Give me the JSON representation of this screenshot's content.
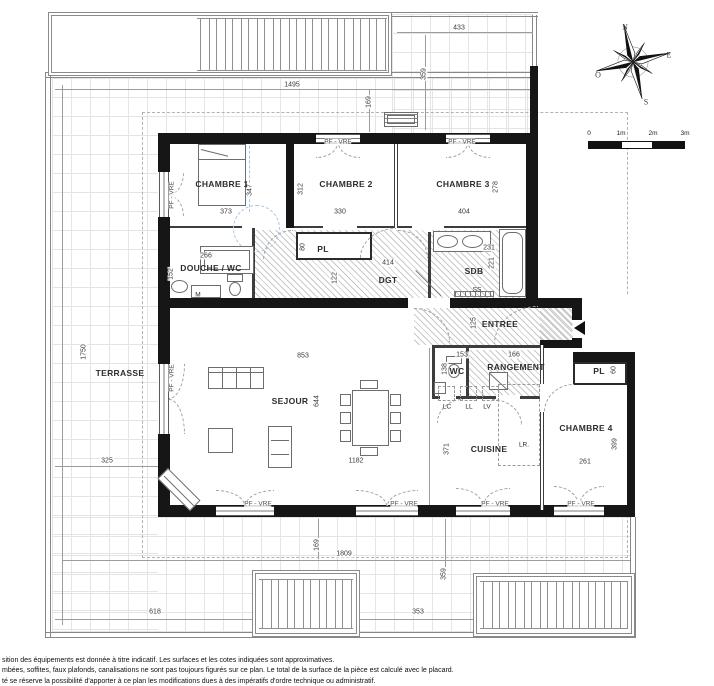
{
  "plan": {
    "window_label": "PF - VRE",
    "room_labels": [
      {
        "id": "chambre-1",
        "t": "CHAMBRE 1",
        "x": 222,
        "y": 184
      },
      {
        "id": "chambre-2",
        "t": "CHAMBRE 2",
        "x": 346,
        "y": 184
      },
      {
        "id": "chambre-3",
        "t": "CHAMBRE 3",
        "x": 463,
        "y": 184
      },
      {
        "id": "chambre-4",
        "t": "CHAMBRE 4",
        "x": 586,
        "y": 428
      },
      {
        "id": "douche-wc",
        "t": "DOUCHE / WC",
        "x": 211,
        "y": 268
      },
      {
        "id": "degagement",
        "t": "DGT",
        "x": 388,
        "y": 280
      },
      {
        "id": "salle-de-bains",
        "t": "SDB",
        "x": 474,
        "y": 271
      },
      {
        "id": "entree",
        "t": "ENTREE",
        "x": 500,
        "y": 324
      },
      {
        "id": "wc",
        "t": "WC",
        "x": 457,
        "y": 371
      },
      {
        "id": "rangement",
        "t": "RANGEMENT",
        "x": 516,
        "y": 367
      },
      {
        "id": "placard-couloir",
        "t": "PL",
        "x": 323,
        "y": 249
      },
      {
        "id": "placard-chambre-4",
        "t": "PL",
        "x": 599,
        "y": 371
      },
      {
        "id": "sejour",
        "t": "SEJOUR",
        "x": 290,
        "y": 401
      },
      {
        "id": "cuisine",
        "t": "CUISINE",
        "x": 489,
        "y": 449
      },
      {
        "id": "terrasse",
        "t": "TERRASSE",
        "x": 120,
        "y": 373
      }
    ],
    "dim_labels": [
      {
        "v": "1495",
        "x": 292,
        "y": 85
      },
      {
        "v": "433",
        "x": 459,
        "y": 28
      },
      {
        "v": "373",
        "x": 226,
        "y": 212
      },
      {
        "v": "330",
        "x": 340,
        "y": 212
      },
      {
        "v": "404",
        "x": 464,
        "y": 212
      },
      {
        "v": "266",
        "x": 206,
        "y": 256
      },
      {
        "v": "414",
        "x": 388,
        "y": 263
      },
      {
        "v": "231",
        "x": 489,
        "y": 248
      },
      {
        "v": "153",
        "x": 462,
        "y": 355
      },
      {
        "v": "166",
        "x": 514,
        "y": 355
      },
      {
        "v": "853",
        "x": 303,
        "y": 356
      },
      {
        "v": "1182",
        "x": 356,
        "y": 461
      },
      {
        "v": "261",
        "x": 585,
        "y": 462
      },
      {
        "v": "325",
        "x": 107,
        "y": 461
      },
      {
        "v": "618",
        "x": 155,
        "y": 612
      },
      {
        "v": "1809",
        "x": 344,
        "y": 554
      },
      {
        "v": "353",
        "x": 418,
        "y": 612
      },
      {
        "v": "359",
        "x": 424,
        "y": 74,
        "r": 1
      },
      {
        "v": "169",
        "x": 369,
        "y": 102,
        "r": 1
      },
      {
        "v": "347",
        "x": 250,
        "y": 190,
        "r": 1
      },
      {
        "v": "312",
        "x": 301,
        "y": 189,
        "r": 1
      },
      {
        "v": "278",
        "x": 496,
        "y": 187,
        "r": 1
      },
      {
        "v": "152",
        "x": 171,
        "y": 274,
        "r": 1
      },
      {
        "v": "80",
        "x": 303,
        "y": 247,
        "r": 1
      },
      {
        "v": "122",
        "x": 335,
        "y": 278,
        "r": 1
      },
      {
        "v": "221",
        "x": 492,
        "y": 263,
        "r": 1
      },
      {
        "v": "125",
        "x": 474,
        "y": 323,
        "r": 1
      },
      {
        "v": "138",
        "x": 445,
        "y": 369,
        "r": 1
      },
      {
        "v": "644",
        "x": 317,
        "y": 401,
        "r": 1
      },
      {
        "v": "371",
        "x": 447,
        "y": 449,
        "r": 1
      },
      {
        "v": "399",
        "x": 615,
        "y": 444,
        "r": 1
      },
      {
        "v": "60",
        "x": 614,
        "y": 370,
        "r": 1
      },
      {
        "v": "1750",
        "x": 84,
        "y": 352,
        "r": 1
      },
      {
        "v": "169",
        "x": 317,
        "y": 545,
        "r": 1
      },
      {
        "v": "359",
        "x": 444,
        "y": 574,
        "r": 1
      }
    ],
    "window_label_positions": [
      {
        "x": 172,
        "y": 195,
        "r": 1
      },
      {
        "x": 338,
        "y": 142
      },
      {
        "x": 462,
        "y": 142
      },
      {
        "x": 172,
        "y": 378,
        "r": 1
      },
      {
        "x": 258,
        "y": 504
      },
      {
        "x": 404,
        "y": 504
      },
      {
        "x": 495,
        "y": 504
      },
      {
        "x": 581,
        "y": 504
      }
    ],
    "equipment_labels": [
      {
        "id": "machine",
        "t": "M",
        "x": 198,
        "y": 295
      },
      {
        "id": "seche-serviettes",
        "t": "SS",
        "x": 477,
        "y": 290
      },
      {
        "id": "lave-char",
        "t": "LC",
        "x": 447,
        "y": 407
      },
      {
        "id": "lave-linge",
        "t": "LL",
        "x": 469,
        "y": 407
      },
      {
        "id": "lave-vaisselle",
        "t": "LV",
        "x": 487,
        "y": 407
      },
      {
        "id": "refrigerateur",
        "t": "LR.",
        "x": 524,
        "y": 445
      }
    ]
  },
  "compass": {
    "n": "N",
    "e": "E",
    "s": "S",
    "o": "O"
  },
  "scale_bar": {
    "ticks": [
      "0",
      "1m",
      "2m",
      "3m"
    ]
  },
  "footer": {
    "lines": [
      "sition des équipements est donnée à titre indicatif. Les surfaces et les cotes indiquées sont approximatives.",
      "mbées, soffites, faux plafonds, canalisations ne sont pas toujours figurés sur ce plan. Le total de la surface de la pièce est calculé avec le placard.",
      "té se réserve la possibilité d'apporter à ce plan les modifications dues à des impératifs d'ordre technique ou administratif."
    ]
  }
}
